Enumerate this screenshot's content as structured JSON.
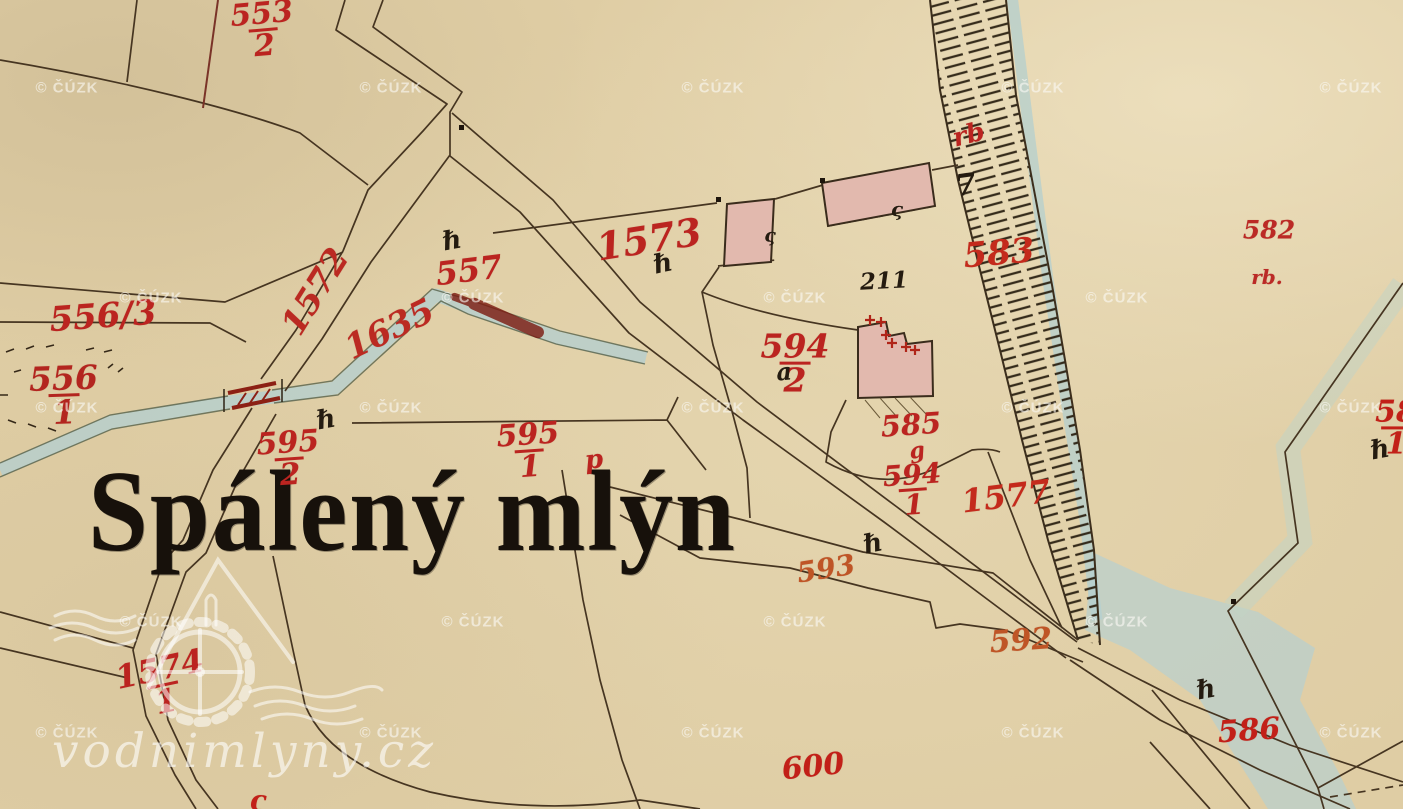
{
  "map": {
    "place_name": "Spálený mlýn",
    "watermarks": {
      "text": "© ČÚZK",
      "positions": [
        [
          67,
          88
        ],
        [
          391,
          88
        ],
        [
          713,
          88
        ],
        [
          1033,
          88
        ],
        [
          1351,
          88
        ],
        [
          151,
          298
        ],
        [
          473,
          298
        ],
        [
          795,
          298
        ],
        [
          1117,
          298
        ],
        [
          67,
          408
        ],
        [
          391,
          408
        ],
        [
          713,
          408
        ],
        [
          1033,
          408
        ],
        [
          1351,
          408
        ],
        [
          151,
          622
        ],
        [
          473,
          622
        ],
        [
          795,
          622
        ],
        [
          1117,
          622
        ],
        [
          67,
          733
        ],
        [
          391,
          733
        ],
        [
          713,
          733
        ],
        [
          1033,
          733
        ],
        [
          1351,
          733
        ]
      ]
    },
    "logo": {
      "text": "vodnimlyny.cz"
    },
    "parcel_labels": [
      {
        "num": "553",
        "den": "2",
        "x": 263,
        "y": 30,
        "rot": -5,
        "size": 30,
        "color": "#bb2420"
      },
      {
        "text": "556/3",
        "x": 103,
        "y": 317,
        "rot": -4,
        "size": 34,
        "color": "#bb2420"
      },
      {
        "num": "556",
        "den": "1",
        "x": 64,
        "y": 396,
        "rot": -2,
        "size": 33,
        "color": "#b3251f"
      },
      {
        "text": "1572",
        "x": 316,
        "y": 292,
        "rot": -58,
        "size": 34,
        "color": "#bb2a22"
      },
      {
        "text": "1635",
        "x": 390,
        "y": 330,
        "rot": -26,
        "size": 34,
        "color": "#bb2a22"
      },
      {
        "text": "557",
        "x": 469,
        "y": 271,
        "rot": -7,
        "size": 32,
        "color": "#bb2420"
      },
      {
        "text": "1573",
        "x": 649,
        "y": 240,
        "rot": -9,
        "size": 38,
        "color": "#bb2420"
      },
      {
        "num": "594",
        "den": "2",
        "x": 795,
        "y": 364,
        "rot": 0,
        "size": 33,
        "color": "#bb2420"
      },
      {
        "text": "585",
        "x": 911,
        "y": 425,
        "rot": -4,
        "size": 29,
        "color": "#bb2420"
      },
      {
        "text": "g",
        "x": 917,
        "y": 451,
        "rot": -8,
        "size": 22,
        "color": "#bb2420"
      },
      {
        "num": "594",
        "den": "1",
        "x": 913,
        "y": 490,
        "rot": -4,
        "size": 28,
        "color": "#bb2420"
      },
      {
        "text": "1577",
        "x": 1006,
        "y": 497,
        "rot": -7,
        "size": 32,
        "color": "#c42a1c"
      },
      {
        "text": "583",
        "x": 999,
        "y": 254,
        "rot": -5,
        "size": 34,
        "color": "#c42a1c"
      },
      {
        "text": "rb",
        "x": 969,
        "y": 136,
        "rot": -14,
        "size": 26,
        "color": "#bb2420"
      },
      {
        "text": "582",
        "x": 1269,
        "y": 230,
        "rot": 0,
        "size": 25,
        "color": "#bb2a26"
      },
      {
        "text": "rb.",
        "x": 1267,
        "y": 277,
        "rot": 0,
        "size": 20,
        "color": "#bb2a26"
      },
      {
        "text": "593",
        "x": 826,
        "y": 569,
        "rot": -9,
        "size": 28,
        "color": "#bf5526"
      },
      {
        "text": "592",
        "x": 1021,
        "y": 641,
        "rot": -4,
        "size": 30,
        "color": "#bf5526"
      },
      {
        "text": "586",
        "x": 1249,
        "y": 731,
        "rot": -4,
        "size": 30,
        "color": "#c22018"
      },
      {
        "num": "58",
        "den": "1",
        "x": 1396,
        "y": 428,
        "rot": 0,
        "size": 30,
        "color": "#c22018"
      },
      {
        "text": "600",
        "x": 813,
        "y": 767,
        "rot": -6,
        "size": 30,
        "color": "#c22018"
      },
      {
        "num": "1574",
        "den": "1",
        "x": 163,
        "y": 686,
        "rot": -12,
        "size": 32,
        "color": "#bb2420"
      },
      {
        "num": "595",
        "den": "2",
        "x": 289,
        "y": 459,
        "rot": -4,
        "size": 30,
        "color": "#bb2420"
      },
      {
        "num": "595",
        "den": "1",
        "x": 529,
        "y": 451,
        "rot": -4,
        "size": 30,
        "color": "#bb2420"
      },
      {
        "text": "p",
        "x": 594,
        "y": 461,
        "rot": -6,
        "size": 26,
        "color": "#bb2420"
      },
      {
        "text": "ς",
        "x": 258,
        "y": 801,
        "rot": 0,
        "size": 28,
        "color": "#c22018"
      }
    ],
    "ink_symbols": [
      {
        "glyph": "ℏ",
        "x": 452,
        "y": 241,
        "rot": -10,
        "size": 26
      },
      {
        "glyph": "ℏ",
        "x": 663,
        "y": 264,
        "rot": -12,
        "size": 26
      },
      {
        "glyph": "ℏ",
        "x": 326,
        "y": 420,
        "rot": -10,
        "size": 26
      },
      {
        "glyph": "ℏ",
        "x": 873,
        "y": 544,
        "rot": -12,
        "size": 26
      },
      {
        "glyph": "ℏ",
        "x": 1206,
        "y": 690,
        "rot": -10,
        "size": 26
      },
      {
        "glyph": "ℏ",
        "x": 1380,
        "y": 450,
        "rot": -10,
        "size": 26
      },
      {
        "glyph": "7",
        "x": 966,
        "y": 186,
        "rot": -8,
        "size": 30
      },
      {
        "glyph": "211",
        "x": 884,
        "y": 281,
        "rot": -3,
        "size": 23
      },
      {
        "glyph": "ς",
        "x": 770,
        "y": 236,
        "rot": 0,
        "size": 19
      },
      {
        "glyph": "ς",
        "x": 897,
        "y": 209,
        "rot": 0,
        "size": 20
      },
      {
        "glyph": "a",
        "x": 784,
        "y": 372,
        "rot": -5,
        "size": 24
      }
    ],
    "colors": {
      "paper": "#dfcda4",
      "ink": "#463521",
      "parcel_red": "#bb2420",
      "water": "#b7cfcd",
      "building_pink": "#e2b9ae",
      "bridge_red": "#8c2014",
      "watermark": "#faf8f4"
    }
  }
}
